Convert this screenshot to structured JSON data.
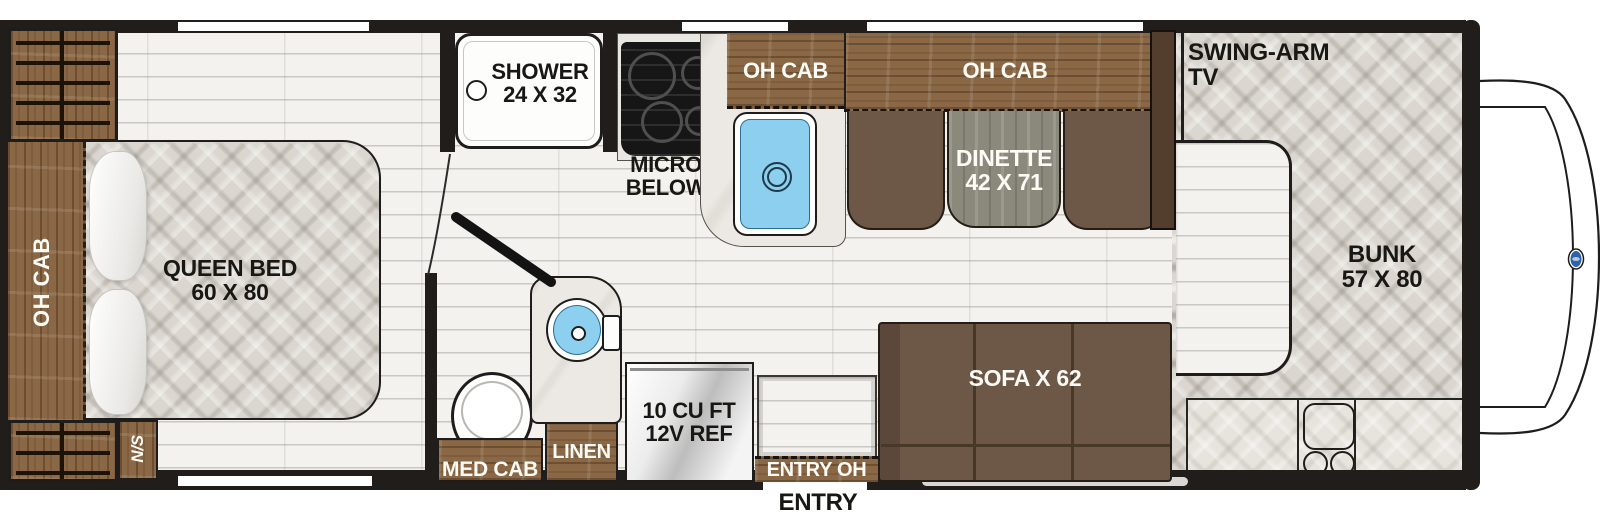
{
  "floorplan": {
    "labels": {
      "rear_overhead": "OH CAB",
      "queen_bed": [
        "QUEEN BED",
        "60 X 80"
      ],
      "nightstand": "N/S",
      "shower": [
        "SHOWER",
        "24 X 32"
      ],
      "micro": [
        "MICRO",
        "BELOW"
      ],
      "kitchen_overhead": "OH CAB",
      "dinette_overhead": "OH CAB",
      "dinette": [
        "DINETTE",
        "42 X 71"
      ],
      "swing_arm_tv": "SWING-ARM TV",
      "bunk": [
        "BUNK",
        "57 X 80"
      ],
      "sofa": "SOFA X 62",
      "refrigerator": [
        "10 CU FT",
        "12V REF"
      ],
      "med_cab": "MED CAB",
      "linen": "LINEN",
      "entry_overhead": "ENTRY OH",
      "entry": "ENTRY"
    },
    "colors": {
      "wall": "#201d1b",
      "cabinet_wood": "#8a6845",
      "bench_brown": "#6d5747",
      "table_wood": "#8b887c",
      "mattress": "#dbd7d0",
      "floor": "#f3f2ef",
      "sink_blue": "#8ccfee",
      "marble": "#ece9e4",
      "vehicle_badge_blue": "#2e62ab",
      "tv_panel": "#533e2d"
    }
  }
}
